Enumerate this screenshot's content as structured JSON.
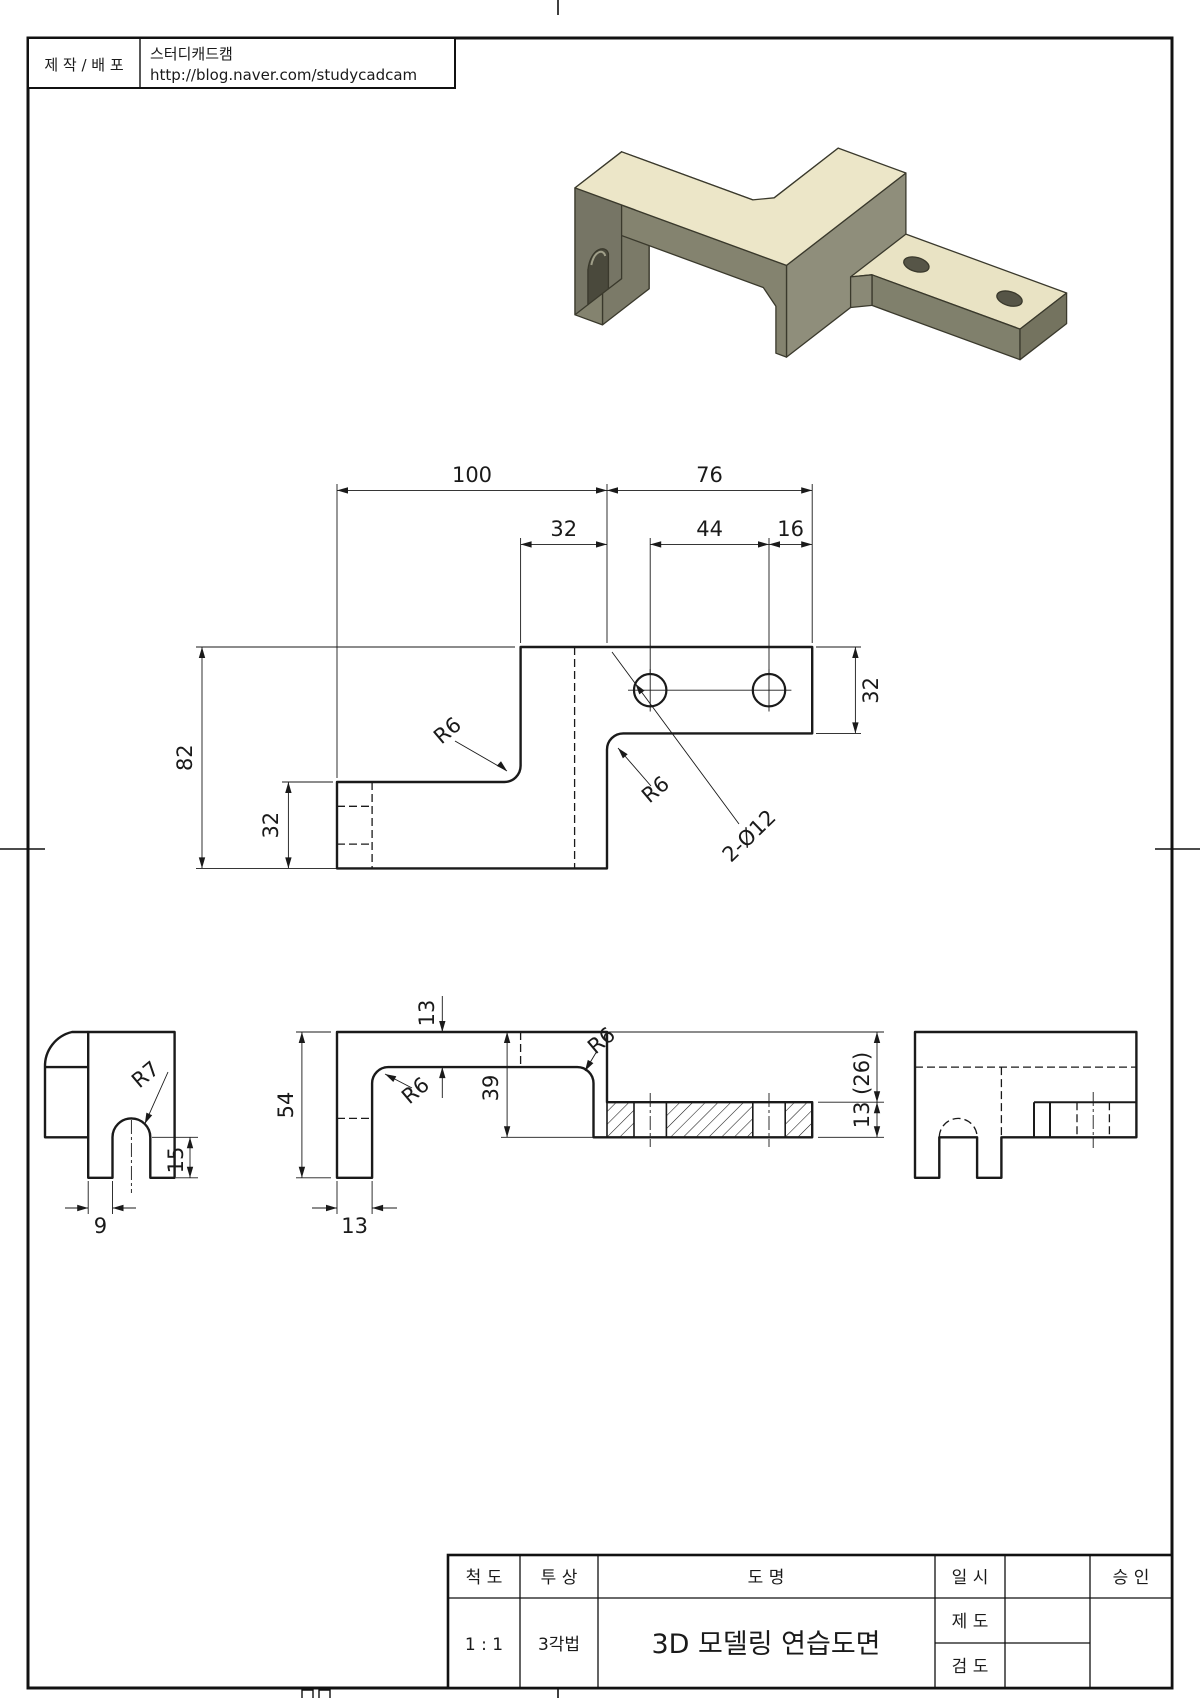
{
  "publisher": {
    "label": "제 작 / 배 포",
    "name": "스터디캐드캠",
    "url": "http://blog.naver.com/studycadcam"
  },
  "title_block": {
    "scale_label": "척  도",
    "scale_value": "1 : 1",
    "projection_label": "투  상",
    "projection_value": "3각법",
    "drawing_label": "도     명",
    "drawing_title": "3D 모델링 연습도면",
    "date_label": "일  시",
    "drafter_label": "제  도",
    "checker_label": "검  도",
    "approval_label": "승  인"
  },
  "views": {
    "top": {
      "dims": {
        "w100": "100",
        "w76": "76",
        "w32": "32",
        "w44": "44",
        "w16": "16",
        "h82": "82",
        "h32_left": "32",
        "h32_right": "32",
        "r6_left": "R6",
        "r6_right": "R6",
        "holes": "2-Ø12"
      }
    },
    "front": {
      "dims": {
        "h54": "54",
        "t13_top": "13",
        "d39": "39",
        "w13_bottom": "13",
        "r6_inner": "R6",
        "r6_outer": "R6",
        "plate": "13 (26)"
      }
    },
    "left_side": {
      "dims": {
        "r7": "R7",
        "h15": "15",
        "w9": "9"
      }
    }
  },
  "iso_colors": {
    "top": "#ece6c8",
    "plate_top": "#e9e3c4",
    "light_side": "#dcd6ba",
    "front": "#84836f",
    "right": "#8f8e7b",
    "dark": "#6b6a5a",
    "tunnel": "#4a493c",
    "outline": "#3a392c"
  }
}
